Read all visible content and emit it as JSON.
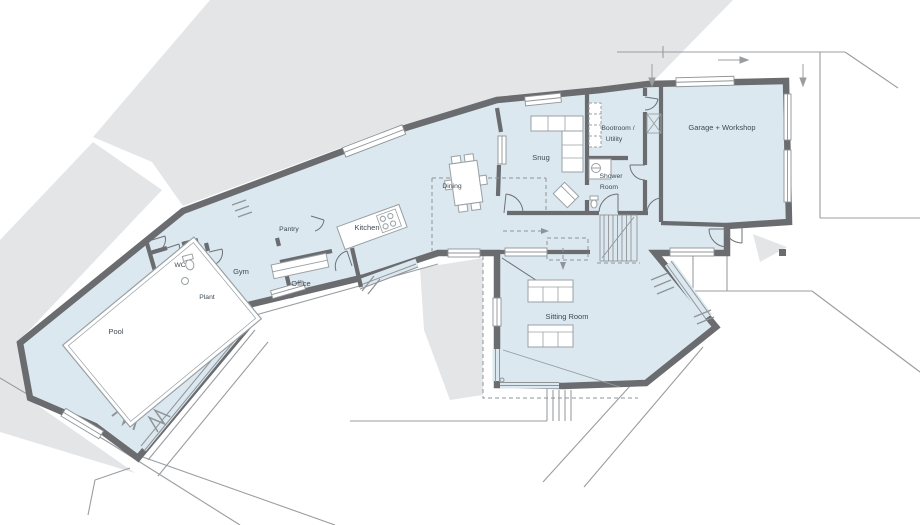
{
  "plan": {
    "title": "Ground floor plan",
    "rooms": {
      "pool": {
        "label": "Pool"
      },
      "wc": {
        "label": "WC"
      },
      "plant": {
        "label": "Plant"
      },
      "gym": {
        "label": "Gym"
      },
      "office": {
        "label": "Office"
      },
      "pantry": {
        "label": "Pantry"
      },
      "kitchen": {
        "label": "Kitchen"
      },
      "dining": {
        "label": "Dining"
      },
      "snug": {
        "label": "Snug"
      },
      "bootroom": {
        "line1": "Bootroom /",
        "line2": "Utility"
      },
      "shower": {
        "line1": "Shower",
        "line2": "Room"
      },
      "sitting": {
        "label": "Sitting Room"
      },
      "garage": {
        "label": "Garage + Workshop"
      }
    },
    "colors": {
      "wall": "#6a6c6f",
      "floor": "#dbe8ef",
      "terrain": "#e4e5e7",
      "thin_line": "#9a9da0",
      "furniture_line": "#9aa0a4",
      "text": "#3e4b55"
    }
  }
}
